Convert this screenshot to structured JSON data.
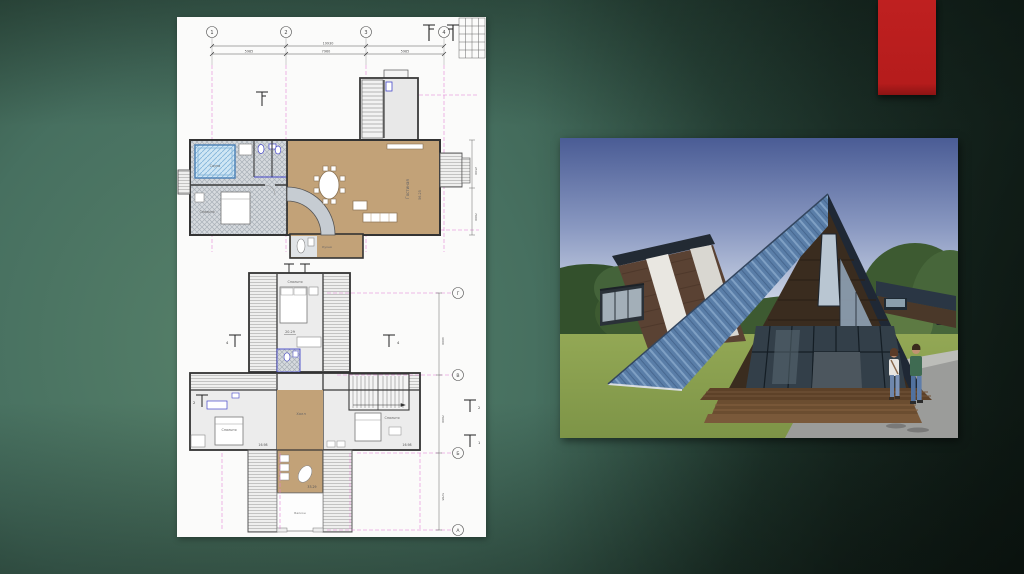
{
  "slide": {
    "background": {
      "light": "#568069",
      "mid": "#3b6152",
      "dark": "#16251d"
    },
    "accent_bar_color": "#b91d1d"
  },
  "plan": {
    "axes_top": [
      "1",
      "2",
      "3",
      "4"
    ],
    "axes_right": [
      "Г",
      "В",
      "Б",
      "А"
    ],
    "dims": {
      "total": "19930",
      "segments": [
        "5985",
        "7960",
        "5985"
      ],
      "f1_right": [
        "2500",
        "7900"
      ],
      "f2_right": [
        "4000",
        "7900",
        "5785"
      ]
    },
    "floor1": {
      "sauna": "Сауна",
      "bedroom": "Спальня",
      "living": "Гостиная",
      "living_area": "56.25",
      "kitchen": "Кухня"
    },
    "floor2": {
      "bedroom_top": "Спальня",
      "bedroom_top_area": "20.29",
      "bedroom_left": "Спальня",
      "bedroom_left_area": "16.98",
      "bedroom_right": "Спальня",
      "bedroom_right_area": "16.98",
      "hall": "Холл",
      "hall_area": "33.29",
      "balcony": "Балкон"
    },
    "sections": [
      "4",
      "4",
      "2",
      "2",
      "1"
    ]
  },
  "photo": {
    "subject": "A-frame house exterior render",
    "sky_top": "#4a5c95",
    "sky_horizon": "#c9d2e4",
    "roof_color": "#5a7ea8",
    "wood_color": "#5a4233",
    "grass_color": "#8ba050",
    "path_color": "#9b9c9a"
  }
}
